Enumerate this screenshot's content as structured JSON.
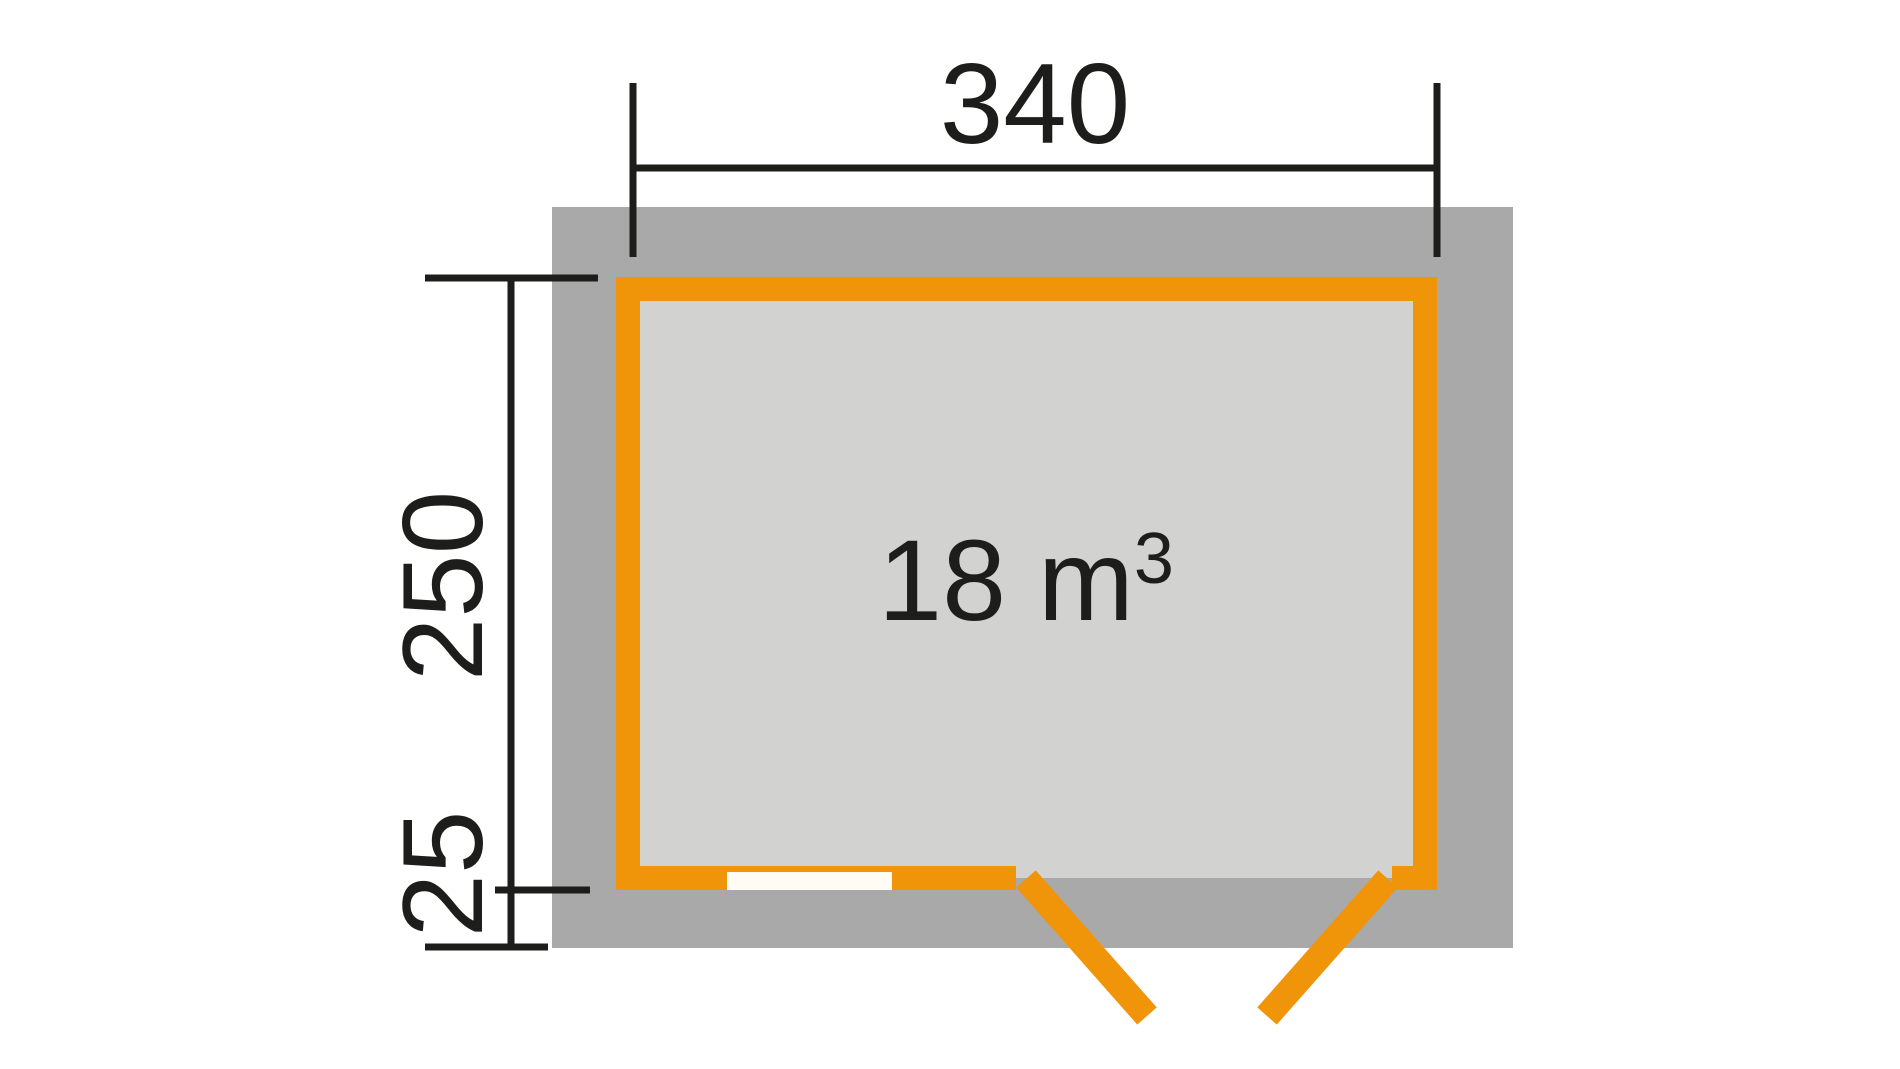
{
  "plan": {
    "width_label": "340",
    "depth_label": "250",
    "overhang_label": "25",
    "volume_main": "18 m",
    "volume_exponent": "3"
  },
  "colors": {
    "background": "#FFFFFF",
    "overhang_gray": "#A9A9A9",
    "wall_orange": "#F0940A",
    "interior_gray": "#D2D2D1",
    "window_white": "#FFFDF3",
    "line_black": "#1D1D1B"
  }
}
